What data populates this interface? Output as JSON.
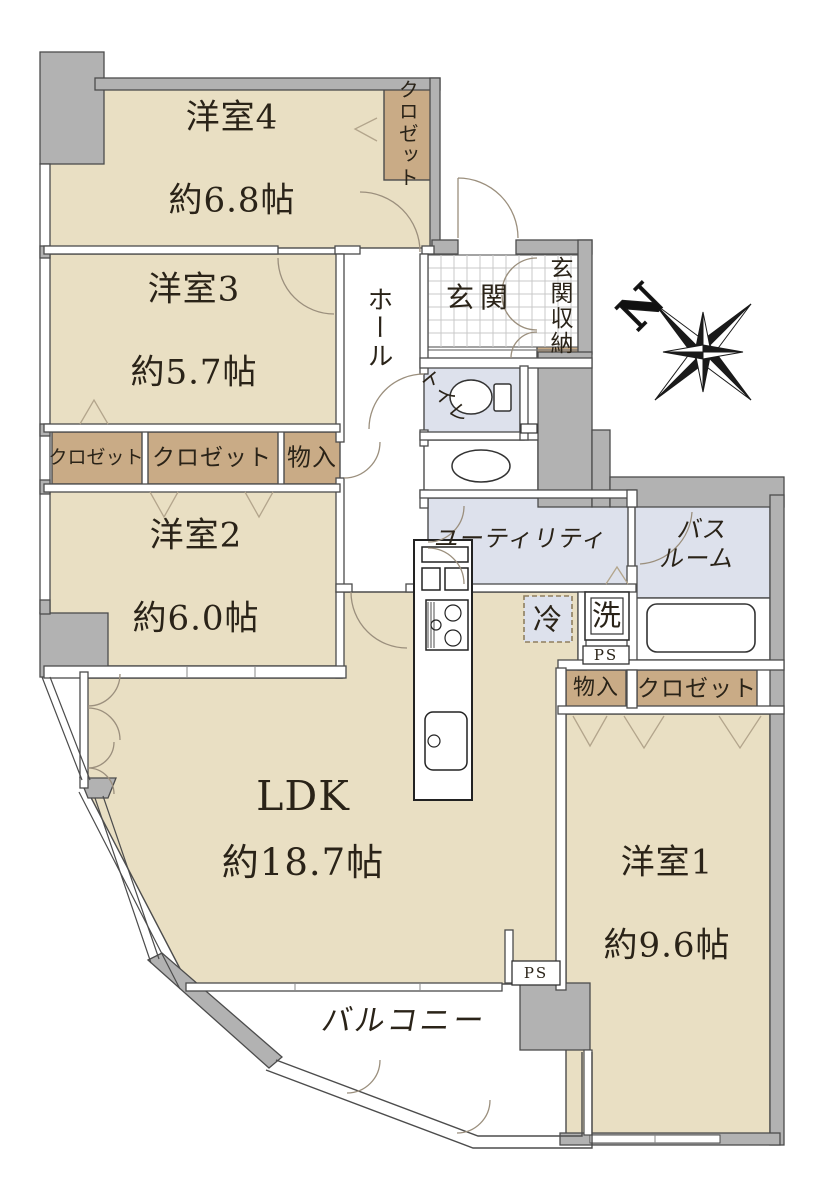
{
  "colors": {
    "wall_gray": "#b2b2b2",
    "room_beige": "#e9dfc3",
    "closet_tan": "#c9ab86",
    "wet_blue": "#dde1ec",
    "line_dark": "#4c4c4c"
  },
  "compass": {
    "north_label": "N"
  },
  "rooms": {
    "youshitsu4": {
      "name": "洋室4",
      "size": "約6.8帖"
    },
    "youshitsu3": {
      "name": "洋室3",
      "size": "約5.7帖"
    },
    "youshitsu2": {
      "name": "洋室2",
      "size": "約6.0帖"
    },
    "youshitsu1": {
      "name": "洋室1",
      "size": "約9.6帖"
    },
    "ldk": {
      "name": "LDK",
      "size": "約18.7帖"
    }
  },
  "areas": {
    "genkan": "玄関",
    "genkan_storage": "玄関収納",
    "hall": "ホール",
    "toilet": "トイレ",
    "utility": "ユーティリティ",
    "bathroom": "バスルーム",
    "bathroom_display": "バス\nルーム",
    "balcony": "バルコニー"
  },
  "storage": {
    "closet_y4": "クロゼット",
    "closet_left_small": "クロゼット",
    "closet_left_large": "クロゼット",
    "monoire_hall": "物入",
    "monoire_y1": "物入",
    "closet_y1": "クロゼット"
  },
  "equipment": {
    "refrigerator": "冷",
    "washer": "洗",
    "pipe_space_1": "PS",
    "pipe_space_2": "PS"
  }
}
